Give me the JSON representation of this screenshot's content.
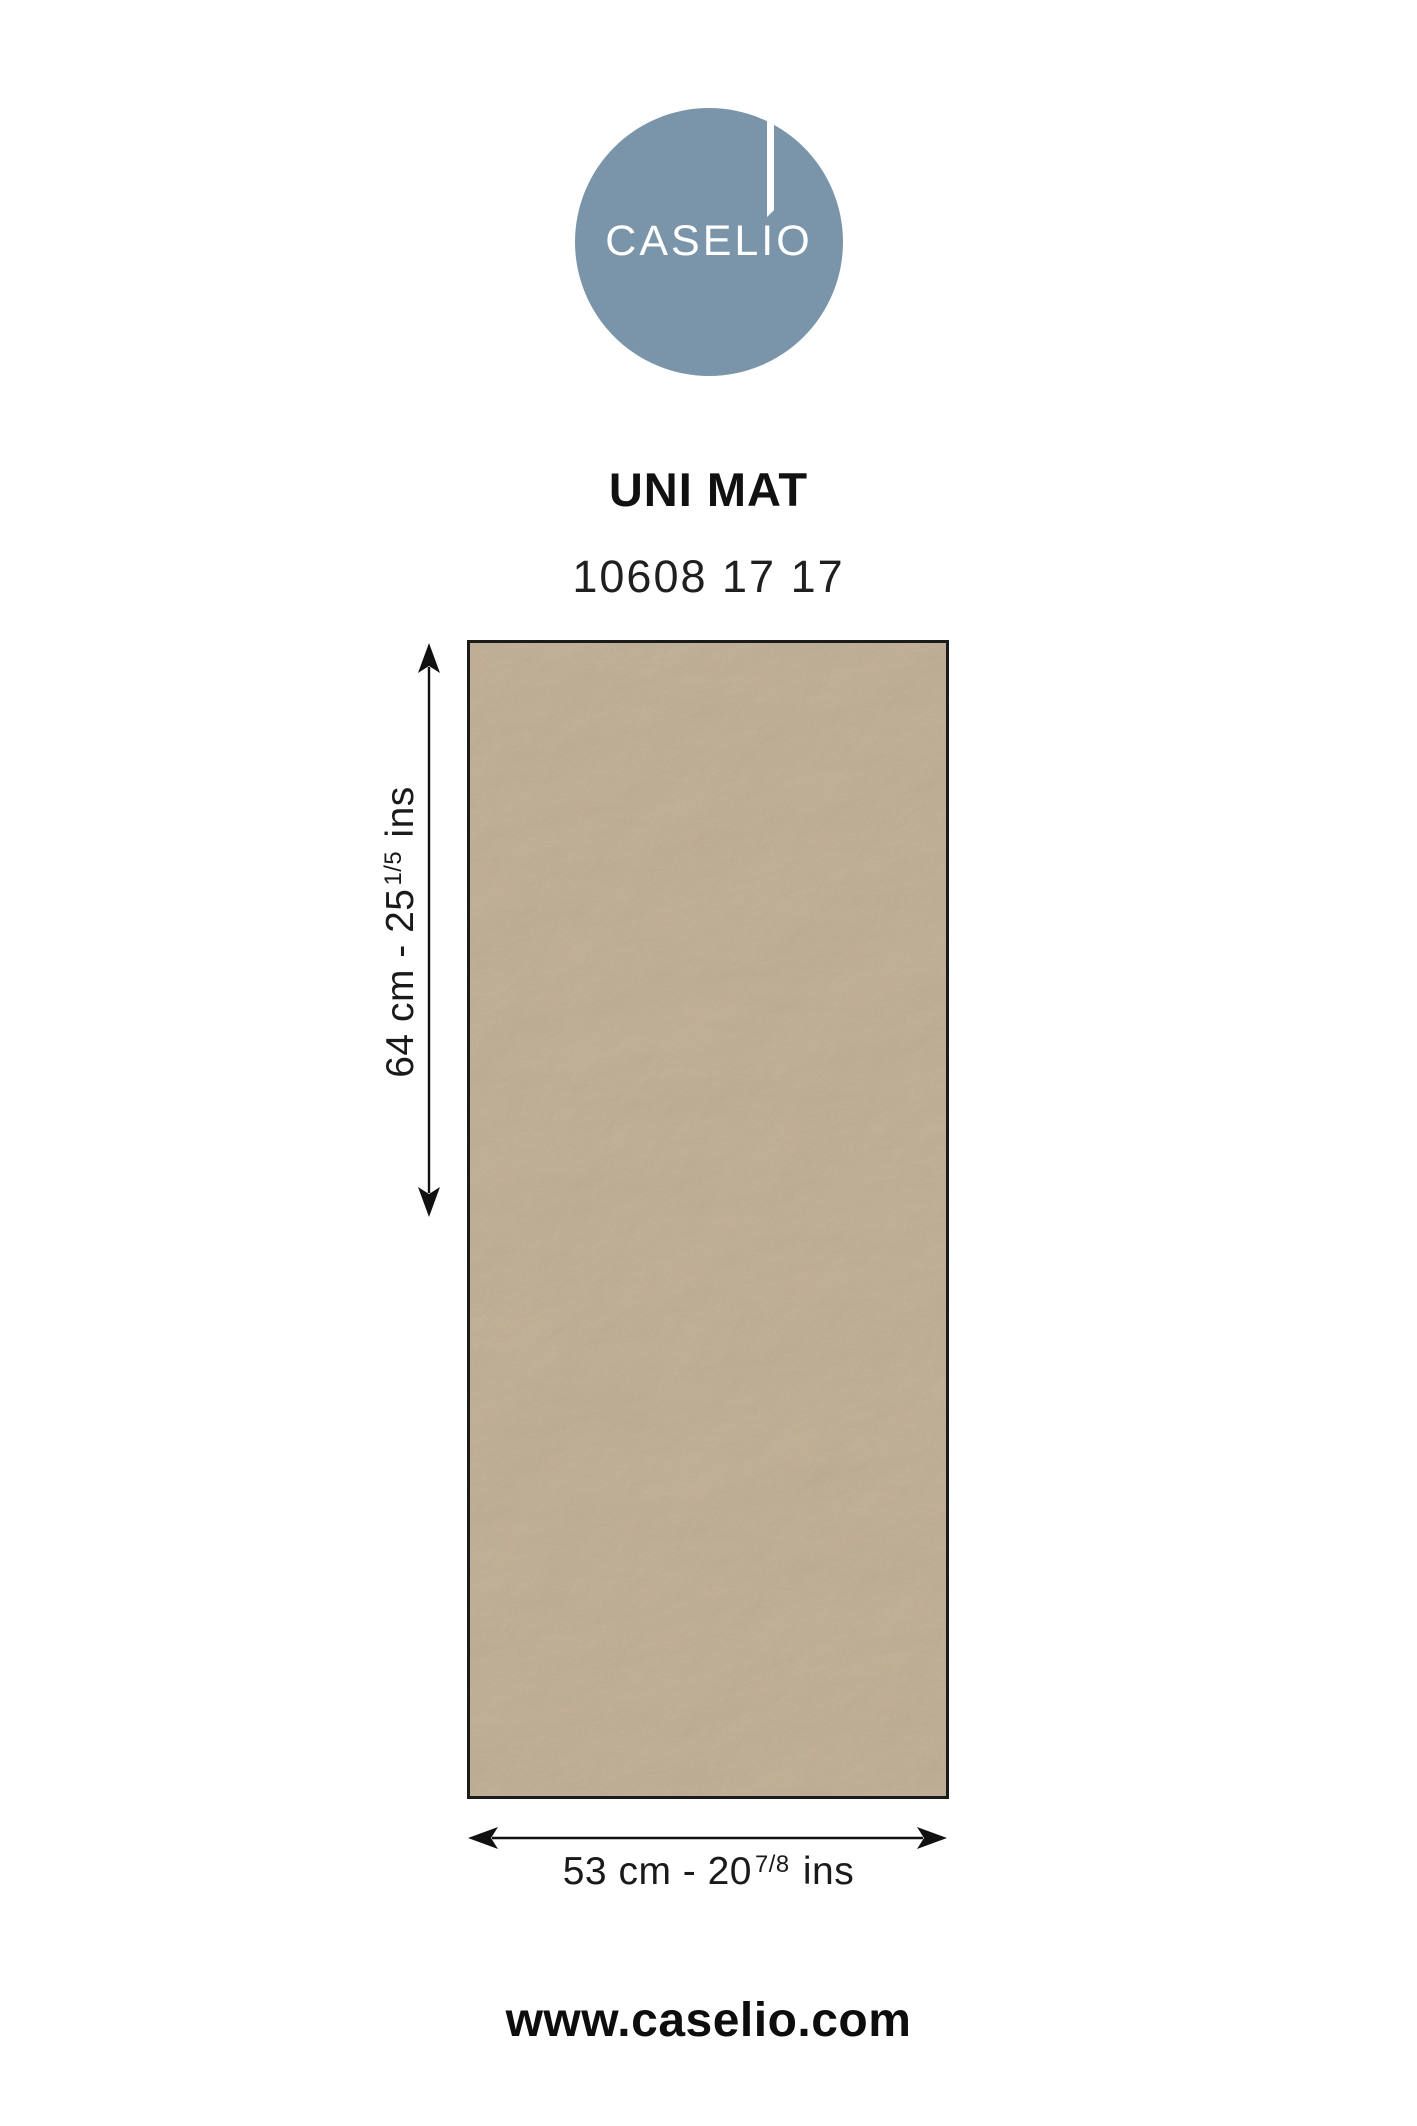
{
  "brand": {
    "logo_text_left": "CASEL",
    "logo_text_i": "I",
    "logo_text_right": "O",
    "logo_full_text": "CASELIO",
    "logo_circle_color": "#7a95a9",
    "logo_text_color": "#ffffff"
  },
  "product": {
    "collection_name": "UNI MAT",
    "reference": "10608 17 17"
  },
  "swatch": {
    "kind": "plain-matte-textured-wallpaper-sample",
    "base_color": "#b09d85",
    "highlight_color": "#d6c6ab",
    "border_color": "#1b1b1b"
  },
  "dimensions": {
    "height": {
      "prefix": "64 cm - 25",
      "fraction": "1/5",
      "suffix": "ins",
      "full": "64 cm - 25 1/5 ins"
    },
    "width": {
      "prefix": "53 cm - 20",
      "fraction": "7/8",
      "suffix": "ins",
      "full": "53 cm - 20 7/8 ins"
    }
  },
  "footer": {
    "website": "www.caselio.com"
  }
}
